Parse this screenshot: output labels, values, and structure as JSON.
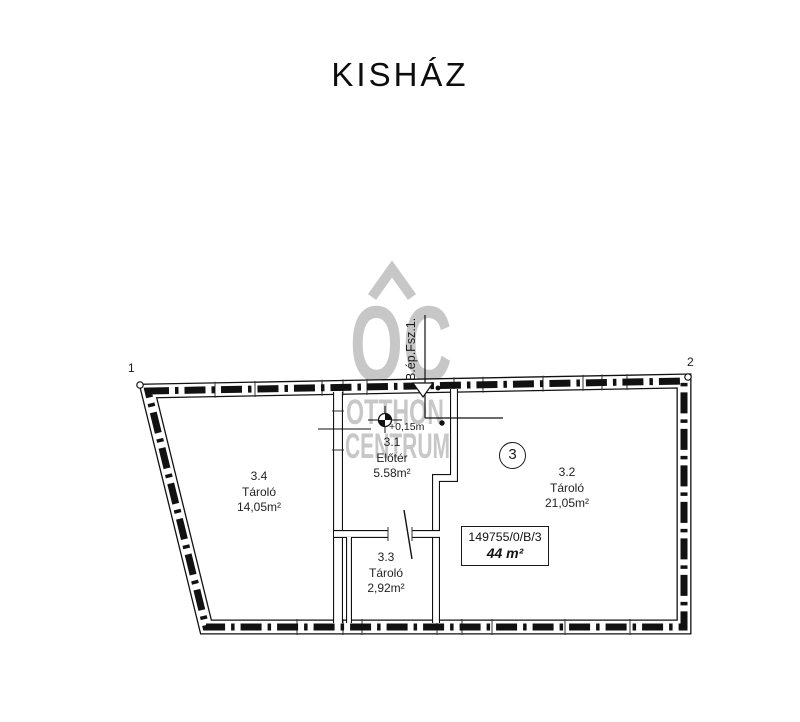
{
  "page": {
    "title": "KISHÁZ"
  },
  "plan": {
    "corner_markers": {
      "left": "1",
      "right": "2"
    },
    "building_label": "B.ép.Fsz.1.",
    "level_label": "+0,15m",
    "unit_number": "3",
    "rooms": [
      {
        "id": "3.4",
        "name": "Tároló",
        "area": "14,05m²"
      },
      {
        "id": "3.1",
        "name": "Előtér",
        "area": "5.58m²"
      },
      {
        "id": "3.3",
        "name": "Tároló",
        "area": "2,92m²"
      },
      {
        "id": "3.2",
        "name": "Tároló",
        "area": "21,05m²"
      }
    ],
    "parcel_box": {
      "parcel_id": "149755/0/B/3",
      "total_area": "44 m²"
    }
  },
  "watermark": {
    "monogram": "OC",
    "line1": "OTTHON",
    "line2": "CENTRUM"
  },
  "colors": {
    "ink": "#111111",
    "watermark": "#c7c7c7"
  }
}
